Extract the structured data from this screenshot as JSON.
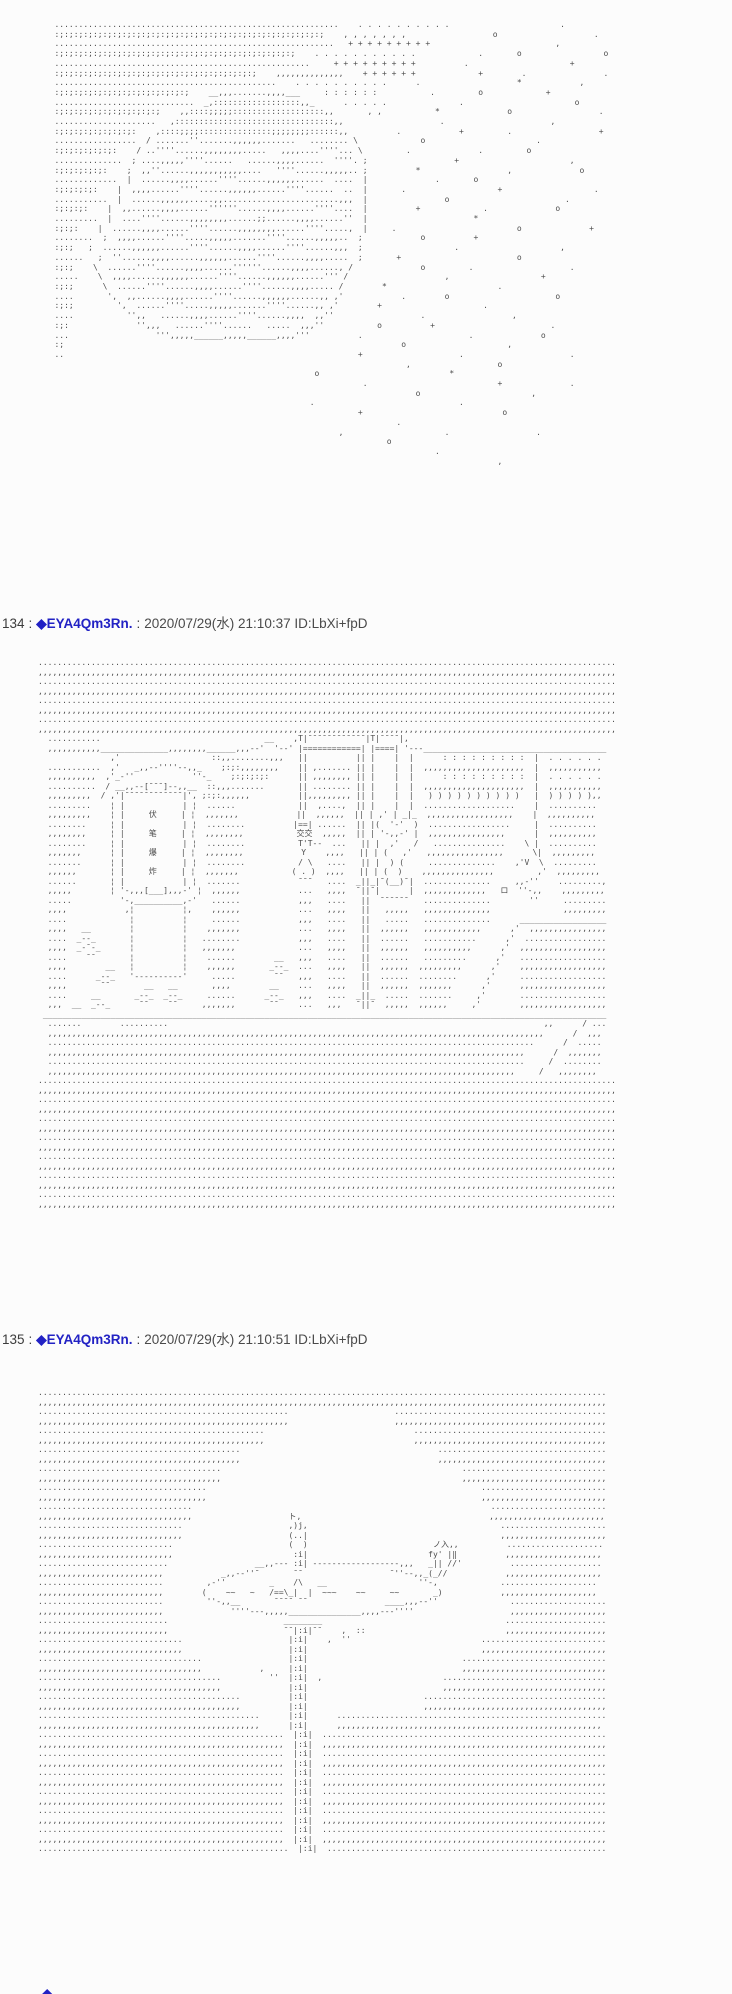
{
  "posts": [
    {
      "number": "134",
      "sep": ":",
      "name": "◆EYA4Qm3Rn.",
      "sep2": ":",
      "datetime": "2020/07/29(水) 21:10:37",
      "id": "ID:LbXi+fpD"
    },
    {
      "number": "135",
      "sep": ":",
      "name": "◆EYA4Qm3Rn.",
      "sep2": ":",
      "datetime": "2020/07/29(水) 21:10:51",
      "id": "ID:LbXi+fpD"
    }
  ],
  "partial_post": {
    "diamond": "◆"
  },
  "colors": {
    "name_blue": "#2222c4",
    "aa_gray": "#4d4d4d",
    "background": "#fcfcfc"
  },
  "aa_blocks": {
    "moon_stars": [
      "   ...........................................................    . . . . . . . . . .                       .",
      "   :;:;:;:;:;:;:;:;:;:;:;:;:;:;:;:;:;:;:;:;:;:;:;:;:;:;:;:;    , , , , , , ,                  o                    .",
      "   ..........................................................   + + + + + + + + +                          ,",
      "   :;:;:;:;:;:;:;:;:;:;:;:;:;:;:;:;:;:;:;:;:;:;:;:;:;    . . . . . . . . . . .             .       o                 o",
      "   .....................................................     + + + + + + + + +          .                     +",
      "   :;:;:;:;:;:;:;:;:;:;:;:;:;:;:;:;:;:;:;:;:;    ,,,,,,,,,,,,,,    + + + + + +             +        .                .",
      "   ..............................................    . . . . . . . . . .      .                    *            ,",
      "   :;:;:;:;:;:;:;:;:;:;:;:;:;:;    __,,,.......,,,,___     : : : : : :           .         o             +",
      "   .............................  _,::::::::::::::::::,,_      . . . . .               .                       o",
      "   :;:;:;:;:;:;:;:;:;:;:;    ,,::::;;;;;:::::::::::::::::::,,       , ,           *              o                  .",
      "   .....................   ,:::::::::::::::::::::::::::::::::,,                    .                      ,",
      "   :;:;:;:;:;:;:;:;:    ,::::;;;;:::::::::::::::;;;;;;;;::::::,,          .            +         .                  +",
      "   .................  / .......''.......,,,,,,.......   ........ \\             o                       .",
      "   :;:;:;:;:;:;:    / ..''''......,,,,,,,,.....   ,,,,....''''... \\         .              .         o",
      "   ..............  ; ....,,,,,''''......   ......,,,,......  ''''. ;                  +                       ,",
      "   :;:;:;:;:;:    ;  ,,''......,,,,,,,,,,,....   ''''......,,,,,.. ;          *                  ,              o",
      "   .............  |  ......,,,,......''''......,,,,,,......  ....  |              .       o",
      "   :;:;:;:;:    |  ,,,,......''''......,,,,,,......''''......  ..  |       .                   +                   .",
      "   ...........  |  ......,,,,,,.....,,........................,,,  |                o                        .",
      "   :;:;:;:    |  ,,......,,,,......''''''......,,,,......''''....  |          +             .              o",
      "   .........  |  ....''''......,,,,,,,,......;;......,,,,......''  |                      *",
      "   :;:;:    |  ......,,,,......''''......,,,,,,,,......''''.....,  |     .                         o              +",
      "   ........  ;  ,,,,......''''.....,,,,,.......''''......,,,,,..  ;            o          +",
      "   :;:;   ;  ......,,,,,,......''''......,,,,......''''......,,,  ;                   .                     ,",
      "   ......   ;  ''......,,,,......,,,,,,......''''......,,,,.....  ;       +                        o",
      "   :;:;    \\  ......''''......,,,,......''''''......,,,,......, /              o         .                    .",
      "   .....    \\  ,,,,......,,,,,,......''''......,,,,,,......''' /                    ,                   +",
      "   :;:;      \\  ......''''......,,,,......''''......,,,,..... /        *                       .",
      "   ....       ',  ,,......,,,,......''''......,,,,,,......,, ,'            .        o                      o",
      "   :;:;         ',  ......''''.....,,,,,.......''''......,, ,'        +                     .",
      "   ....           '',,   ......,,,,......''''......,,,,  ,,''                  .                  ,",
      "   :;:              '',,,   ......''''......   .....  ,,,''           o          +                        .",
      "   ...                  ''',,,,,______,,,,,______,,,,'''          .                      .              o",
      "   :;                                                                      o                     ,",
      "   ..                                                             +                    .                      .",
      "                                                                            ,                  o",
      "                                                         o                           *",
      "                                                                   .                           +              .",
      "                                                                              o                       ,",
      "                                                        .                              .",
      "                                                                  +                             o",
      "                                                                          .",
      "                                                              ,                     .                  .",
      "                                                                        o",
      "                                                                                  .",
      "                                                                                               ,"
    ],
    "street_scene": [
      "........................................................................................................................",
      ",,,,,,,,,,,,,,,,,,,,,,,,,,,,,,,,,,,,,,,,,,,,,,,,,,,,,,,,,,,,,,,,,,,,,,,,,,,,,,,,,,,,,,,,,,,,,,,,,,,,,,,,,,,,,,,,,,,,,,,,",
      "........................................................................................................................",
      ",,,,,,,,,,,,,,,,,,,,,,,,,,,,,,,,,,,,,,,,,,,,,,,,,,,,,,,,,,,,,,,,,,,,,,,,,,,,,,,,,,,,,,,,,,,,,,,,,,,,,,,,,,,,,,,,,,,,,,,,",
      "........................................................................................................................",
      ",,,,,,,,,,,,,,,,,,,,,,,,,,,,,,,,,,,,,,,,,,,,,,,,,,,,,,,,,,,,,,,,,,,,,,,,,,,,,,,,,,,,,,,,,,,,,,,,,,,,,,,,,,,,,,,,,,,,,,,,",
      "........................................................................................................................",
      ",,,,,,,,,,,,,,,,,,,,,,,,,,,,,,,,,,,,,,,,,,,,,,,,,,,,,,,,,,,,,,,,,,,,,,,,,,,,,,,,,,,,,,,,,,,,,,,,,,,,,,,,,,,,,,,,,,,,,,,,",
      "  ...........                                  __    ,T|¯¯¯¯¯¯¯¯¯¯¯¯|T|¯¯¯¯|,                                         ",
      "  ,,,,,,,,,,,______________,,,,,,,,______,,,--'  '--' |============| |====| '---______________________________________",
      "               ,'                   ::,,........,,,   ||          || |    |  |      : : : : : : : : :  |  . . . . . . ",
      "  ...........  ,'   _,,--''''--,,_    ;:;:,,,,,,,,    || ,....... || |    |  |  ,,,,,,,,,,,,,,,,,,,,,  |  ,,,,,,,,,,, ",
      "  ,,,,,,,,,,  ,'_-''            ''-_    ;:;:;:;:      || ,,,,,,,, || |    |  |      : : : : : : : : :  |  . . . . . . ",
      "  ..........  / __,,--[¯¯¯]--,,__  ::,,,.......       || ........ || |    |  |  ,,,,,,,,,,,,,,,,,,,,,  |  ,,,,,,,,,,, ",
      "  ,,,,,,,,,  / ,'|¯¯¯¯¯¯¯¯¯¯¯¯|', ;:;:,,,,,,          ||,,,,,,,,, || |    |  |   ) ) ) ) ) ) ) ) ) )   |  ) ) ) ) ),, ",
      "  .........    ¦ |            | ¦  ......             ||  ,....,  || |    |  |  ...................    |  ..........  ",
      "  ,,,,,,,,,    ¦ |     伏     | ¦  ,,,,,,,            ||  ,,,,,,  || | ,' | _|_  ,,,,,,,,,,,,,,,,,,    |  ,,,,,,,,,,  ",
      "  ........     ¦ |            | ¦  ........          |==| ......  || |(  '-'  )  .................     |  ..........  ",
      "  ,,,,,,,,     ¦ |     笔     | ¦  ,,,,,,,,           交交  ,,,,,  || | '-,,-' |  ,,,,,,,,,,,,,,,,      |  ,,,,,,,,,,  ",
      "  ........     ¦ |            | ¦  ........           T'T--  ...   || |  ,'   /   ...............    \\ |  ..........  ",
      "  ,,,,,,,      ¦ |     爆     | ¦  ,,,,,,,,            Y    ,,,,   || | (   ,'   ,,,,,,,,,,,,,,,,      \\|  ,,,,,,,,,  ",
      "  .......      ¦ |            | ¦  ........           / \\   ....   || |  ) (     ..............    ,'V  \\  .........  ",
      "  ,,,,,,       ¦ |     炸     | ¦  ,,,,,,,           ( . )  ,,,,   || | (  )    ,,,,,,,,,,,,,,,         ,'  ,,,,,,,,,  ",
      "  ......       ¦ |            | ¦  .......            ¯¯¯   ....  _||_|¯(__)¯|  ..............     ,,-''    .........,",
      "  ,,,,,        ¦ '-,,,[___],,,-' ¦  ,,,,,,            ...   ,,,,  ¯||¯|      |  ,,,,,,,,,,,,,   ロ  ''-,,    ,,,,,,,,,",
      "  .....          '-,__________,-'   ......            ,,,   ....   ||  ¯¯¯¯¯¯   ..............        ''     .........",
      "  ,,,,            ,¦          ¦,    ,,,,,,            ...   ,,,,   ||   ,,,,,   ,,,,,,,,,,,,,,               ,,,,,,,,,",
      "  ....             ¦          ¦     ......            ,,,   ....   ||   .....   ..............      __________________",
      "  ,,,,   __        ¦          ¦    ,,,,,,,            ...   ,,,,   ||  ,,,,,,   ,,,,,,,,,,,,      ,'  ,,,,,,,,,,,,,,,,",
      "  ....  _--_       ¦          ¦   ........            ,,,   ....   ||  ......   ...........      ,'  .................",
      "  ,,,,  _-¯-_      ¦          ¦   ,,,,,,,             ...   ,,,,   ||  ,,,,,,   ,,,,,,,,,,      ,'  ,,,,,,,,,,,,,,,,,,",
      "  ....    ¯¯       ¦          ¦    ......        __   ,,,   ....   ||  ......   .........      ,'   ..................",
      "  ,,,,        __   ¦          ¦    ,,,,,,       _--_  ...   ,,,,   ||  ,,,,,,  ,,,,,,,,,      ,'    ,,,,,,,,,,,,,,,,,,",
      "  ....      _--_   '----------'     .....        ¯¯   ,,,   ....   ||  ......  ........      ,'     ..................",
      "  ,,,,       ¯¯       __   __       ,,,,        __    ...   ,,,,   ||  ,,,,,,  ,,,,,,,      ,'      ,,,,,,,,,,,,,,,,,,",
      "  ....     __       _--_  _--_     ......      _--_   ,,,   ....  _||_  .....  .......     ,'       ..................",
      "  ,,,  __  _--_      ¯¯    ¯¯     ,,,,,,,       ¯¯    ...   ,,,   ¯||¯  ,,,,,  ,,,,,,     ,'        ,,,,,,,,,,,,,,,,,,",
      " _____________________________________________________________________________________________________________________",
      "  .......        ..........                                                                              ,,      / ...",
      "  ,,,,,,,,,,,,,,,,,,,,,,,,,,,,,,,,,,,,,,,,,,,,,,,,,,,,,,,,,,,,,,,,,,,,,,,,,,,,,,,,,,,,,,,,,,,,,,,,,,,,,,,      /  ,,,",
      "  .....................................................................................................      /  .....",
      "  ,,,,,,,,,,,,,,,,,,,,,,,,,,,,,,,,,,,,,,,,,,,,,,,,,,,,,,,,,,,,,,,,,,,,,,,,,,,,,,,,,,,,,,,,,,,,,,,,,,,      /  ,,,,,,,",
      "  ...................................................................................................     /  ........",
      "  ,,,,,,,,,,,,,,,,,,,,,,,,,,,,,,,,,,,,,,,,,,,,,,,,,,,,,,,,,,,,,,,,,,,,,,,,,,,,,,,,,,,,,,,,,,,,,,,,,     /   ,,,,,,,,",
      "........................................................................................................................",
      ",,,,,,,,,,,,,,,,,,,,,,,,,,,,,,,,,,,,,,,,,,,,,,,,,,,,,,,,,,,,,,,,,,,,,,,,,,,,,,,,,,,,,,,,,,,,,,,,,,,,,,,,,,,,,,,,,,,,,,,,",
      "........................................................................................................................",
      ",,,,,,,,,,,,,,,,,,,,,,,,,,,,,,,,,,,,,,,,,,,,,,,,,,,,,,,,,,,,,,,,,,,,,,,,,,,,,,,,,,,,,,,,,,,,,,,,,,,,,,,,,,,,,,,,,,,,,,,,",
      "........................................................................................................................",
      ",,,,,,,,,,,,,,,,,,,,,,,,,,,,,,,,,,,,,,,,,,,,,,,,,,,,,,,,,,,,,,,,,,,,,,,,,,,,,,,,,,,,,,,,,,,,,,,,,,,,,,,,,,,,,,,,,,,,,,,,",
      "........................................................................................................................",
      ",,,,,,,,,,,,,,,,,,,,,,,,,,,,,,,,,,,,,,,,,,,,,,,,,,,,,,,,,,,,,,,,,,,,,,,,,,,,,,,,,,,,,,,,,,,,,,,,,,,,,,,,,,,,,,,,,,,,,,,,",
      "........................................................................................................................",
      ",,,,,,,,,,,,,,,,,,,,,,,,,,,,,,,,,,,,,,,,,,,,,,,,,,,,,,,,,,,,,,,,,,,,,,,,,,,,,,,,,,,,,,,,,,,,,,,,,,,,,,,,,,,,,,,,,,,,,,,,",
      "........................................................................................................................",
      ",,,,,,,,,,,,,,,,,,,,,,,,,,,,,,,,,,,,,,,,,,,,,,,,,,,,,,,,,,,,,,,,,,,,,,,,,,,,,,,,,,,,,,,,,,,,,,,,,,,,,,,,,,,,,,,,,,,,,,,,",
      "........................................................................................................................",
      ",,,,,,,,,,,,,,,,,,,,,,,,,,,,,,,,,,,,,,,,,,,,,,,,,,,,,,,,,,,,,,,,,,,,,,,,,,,,,,,,,,,,,,,,,,,,,,,,,,,,,,,,,,,,,,,,,,,,,,,,"
    ],
    "tree_scene": [
      "......................................................................................................................",
      ",,,,,,,,,,,,,,,,,,,,,,,,,,,,,,,,,,,,,,,,,,,,,,,,,,,,,,,,,,,,,,,,,,,,,,,,,,,,,,,,,,,,,,,,,,,,,,,,,,,,,,,,,,,,,,,,,,,,,,",
      "....................................................                      ............................................",
      ",,,,,,,,,,,,,,,,,,,,,,,,,,,,,,,,,,,,,,,,,,,,,,,,,,,,                      ,,,,,,,,,,,,,,,,,,,,,,,,,,,,,,,,,,,,,,,,,,,,",
      "...............................................                               ........................................",
      ",,,,,,,,,,,,,,,,,,,,,,,,,,,,,,,,,,,,,,,,,,,,,,,                               ,,,,,,,,,,,,,,,,,,,,,,,,,,,,,,,,,,,,,,,,",
      "..........................................                                         ...................................",
      ",,,,,,,,,,,,,,,,,,,,,,,,,,,,,,,,,,,,,,,,,,                                         ,,,,,,,,,,,,,,,,,,,,,,,,,,,,,,,,,,,",
      "......................................                                                  ..............................",
      ",,,,,,,,,,,,,,,,,,,,,,,,,,,,,,,,,,,,,,                                                  ,,,,,,,,,,,,,,,,,,,,,,,,,,,,,,",
      "...................................                                                         ..........................",
      ",,,,,,,,,,,,,,,,,,,,,,,,,,,,,,,,,,,                                                         ,,,,,,,,,,,,,,,,,,,,,,,,,,",
      "................................                                                              ........................",
      ",,,,,,,,,,,,,,,,,,,,,,,,,,,,,,,,                    ト,                                       ,,,,,,,,,,,,,,,,,,,,,,,,",
      "..............................                      ,)j,                                        ......................",
      ",,,,,,,,,,,,,,,,,,,,,,,,,,,,,,                      (..|                                        ,,,,,,,,,,,,,,,,,,,,,,",
      "............................                        (  )                          ノ入,,          ....................",
      ",,,,,,,,,,,,,,,,,,,,,,,,,,,,                         :i|                         fy' |‖          ,,,,,,,,,,,,,,,,,,,,",
      "...........................                  __,,--- :i| ------------------,,,   _|| //'          ...................",
      ",,,,,,,,,,,,,,,,,,,,,,,,,,            _,,--''¯       ¯¯                  ¯''--,,_(_//            ,,,,,,,,,,,,,,,,,,,,",
      "..........................         ,-''         _    /\\   __                   ''-,             ....................",
      ",,,,,,,,,,,,,,,,,,,,,,,,,,        (    ~~   ~   /==\\_|  |  ~~~    ~~     ~~       _)            ,,,,,,,,,,,,,,,,,,,,",
      "..........................         ''-,,__       ¯¯¯¯ ¯¯                ____,,,--''               ....................",
      ",,,,,,,,,,,,,,,,,,,,,,,,,,              ''''---,,,,,_______________,,,,---''''                    ,,,,,,,,,,,,,,,,,,,,",
      "...........................                        ________                                      .....................",
      ",,,,,,,,,,,,,,,,,,,,,,,,,,,                        ¯¯|:i|¯¯    ,  ::                             ,,,,,,,,,,,,,,,,,,,,,",
      "..............................                      |:i|    ,  ''                           ..........................",
      ",,,,,,,,,,,,,,,,,,,,,,,,,,,,,,                      |:i|                                    ,,,,,,,,,,,,,,,,,,,,,,,,,,",
      "..................................                  |:i|                                ..............................",
      ",,,,,,,,,,,,,,,,,,,,,,,,,,,,,,,,,,            ,     |:i|                                ,,,,,,,,,,,,,,,,,,,,,,,,,,,,,,",
      "......................................          ''  |:i|  ,                         ..................................",
      ",,,,,,,,,,,,,,,,,,,,,,,,,,,,,,,,,,,,,,              |:i|                            ,,,,,,,,,,,,,,,,,,,,,,,,,,,,,,,,,,",
      "..........................................          |:i|                        ......................................",
      ",,,,,,,,,,,,,,,,,,,,,,,,,,,,,,,,,,,,,,,,,,          |:i|                        ,,,,,,,,,,,,,,,,,,,,,,,,,,,,,,,,,,,,,,",
      "..............................................      |:i|      ........................................................",
      ",,,,,,,,,,,,,,,,,,,,,,,,,,,,,,,,,,,,,,,,,,,,,,      |:i|      ,,,,,,,,,,,,,,,,,,,,,,,,,,,,,,,,,,,,,,,,,,,,,,,,,,,,,,,",
      "...................................................  |:i|  ...........................................................",
      ",,,,,,,,,,,,,,,,,,,,,,,,,,,,,,,,,,,,,,,,,,,,,,,,,,,  |:i|  ,,,,,,,,,,,,,,,,,,,,,,,,,,,,,,,,,,,,,,,,,,,,,,,,,,,,,,,,,,,",
      "...................................................  |:i|  ...........................................................",
      ",,,,,,,,,,,,,,,,,,,,,,,,,,,,,,,,,,,,,,,,,,,,,,,,,,,  |:i|  ,,,,,,,,,,,,,,,,,,,,,,,,,,,,,,,,,,,,,,,,,,,,,,,,,,,,,,,,,,,",
      "...................................................  |:i|  ...........................................................",
      ",,,,,,,,,,,,,,,,,,,,,,,,,,,,,,,,,,,,,,,,,,,,,,,,,,,  |:i|  ,,,,,,,,,,,,,,,,,,,,,,,,,,,,,,,,,,,,,,,,,,,,,,,,,,,,,,,,,,,",
      "...................................................  |:i|  ...........................................................",
      ",,,,,,,,,,,,,,,,,,,,,,,,,,,,,,,,,,,,,,,,,,,,,,,,,,,  |:i|  ,,,,,,,,,,,,,,,,,,,,,,,,,,,,,,,,,,,,,,,,,,,,,,,,,,,,,,,,,,,",
      "...................................................  |:i|  ...........................................................",
      ",,,,,,,,,,,,,,,,,,,,,,,,,,,,,,,,,,,,,,,,,,,,,,,,,,,  |:i|  ,,,,,,,,,,,,,,,,,,,,,,,,,,,,,,,,,,,,,,,,,,,,,,,,,,,,,,,,,,,",
      "...................................................  |:i|  ...........................................................",
      ",,,,,,,,,,,,,,,,,,,,,,,,,,,,,,,,,,,,,,,,,,,,,,,,,,,  |:i|  ,,,,,,,,,,,,,,,,,,,,,,,,,,,,,,,,,,,,,,,,,,,,,,,,,,,,,,,,,,,",
      "....................................................  |:i|  .........................................................."
    ]
  }
}
